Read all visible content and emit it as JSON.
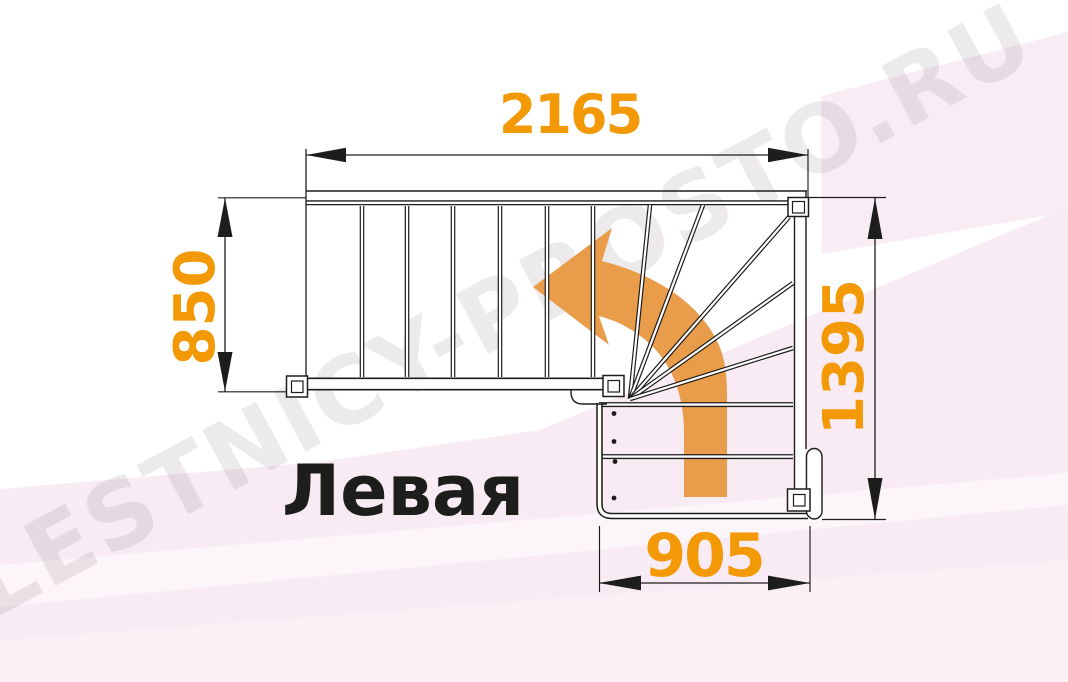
{
  "diagram": {
    "title": "Левая",
    "watermark": "LESTNICY-PROSTO.RU",
    "dimensions": {
      "top_width": "2165",
      "left_height": "850",
      "right_height": "1395",
      "bottom_width": "905"
    },
    "colors": {
      "dimension_text": "#F39905",
      "direction_arrow": "#E99C49",
      "line": "#1D1D1B",
      "background_pink": "#F8EBF3",
      "background_white": "#FFFFFF"
    }
  }
}
